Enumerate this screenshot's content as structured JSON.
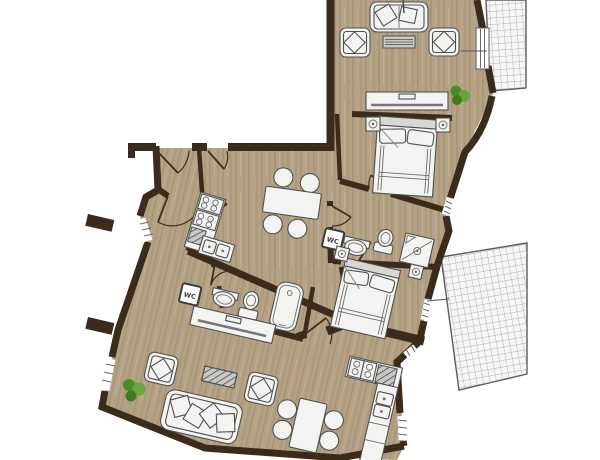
{
  "page": {
    "type": "architectural-floor-plan",
    "background": "#ffffff",
    "units_shown": 2,
    "orientation": "upper unit nearly axis-aligned, lower unit rotated ~13 degrees"
  },
  "labels": {
    "wc_upper": "WC",
    "wc_lower": "WC"
  },
  "colors": {
    "wall": "#3b2b1a",
    "floor": "#b5a285",
    "floor_grain": "#7a6443",
    "furniture_fill": "#f3f3f1",
    "furniture_stroke": "#50504e",
    "furniture_gray": "#d7d7d5",
    "table_top": "#c9c9c7",
    "balcony_bg": "#f6f6f6",
    "balcony_grid": "#9b9b9b",
    "balcony_border": "#5a5a58",
    "plant_dark": "#4a8a28",
    "plant_light": "#66a63e",
    "hatch_bg": "#c8c8c6",
    "hatch_line": "#4a4a48",
    "tv_line": "#6b6b69",
    "white": "#ffffff"
  },
  "rooms": [
    {
      "id": "living-room-upper",
      "furniture": [
        "sofa with 2 pillows",
        "armchair left with pillow",
        "armchair right with pillow",
        "coffee table",
        "tv sideboard",
        "plant"
      ]
    },
    {
      "id": "balcony-upper",
      "surface": "tile grid",
      "access": "balcony door from living room"
    },
    {
      "id": "bedroom-1",
      "furniture": [
        "double bed",
        "nightstand left",
        "nightstand right"
      ],
      "openings": [
        "door",
        "window"
      ]
    },
    {
      "id": "kitchen-dining-upper",
      "furniture": [
        "kitchen counter with 4-burner hob",
        "hatched worktop",
        "double sink",
        "dining table",
        "4 chairs"
      ]
    },
    {
      "id": "bathroom-upper",
      "sign": "WC",
      "furniture": [
        "washbasin",
        "toilet",
        "shower cabin"
      ]
    },
    {
      "id": "bedroom-2",
      "furniture": [
        "double bed",
        "nightstand left",
        "nightstand right"
      ],
      "openings": [
        "window to balcony"
      ]
    },
    {
      "id": "balcony-lower",
      "surface": "tile grid"
    },
    {
      "id": "entry-hall",
      "openings": [
        "entry door 1",
        "entry door 2",
        "door to living room",
        "door to kitchen"
      ]
    },
    {
      "id": "bathroom-lower",
      "sign": "WC",
      "furniture": [
        "washbasin",
        "toilet",
        "bathtub"
      ]
    },
    {
      "id": "living-room-lower",
      "furniture": [
        "tv sideboard",
        "sofa with 4 pillows",
        "armchair left with pillow",
        "armchair right with pillow",
        "hatched coffee table",
        "plant"
      ],
      "openings": [
        "window left upper",
        "window left lower",
        "door to kitchen"
      ]
    },
    {
      "id": "kitchen-dining-lower",
      "furniture": [
        "kitchen counter with 4-burner hob",
        "hatched worktop",
        "double sink",
        "dining table",
        "4 chairs"
      ],
      "openings": [
        "window right"
      ]
    }
  ]
}
